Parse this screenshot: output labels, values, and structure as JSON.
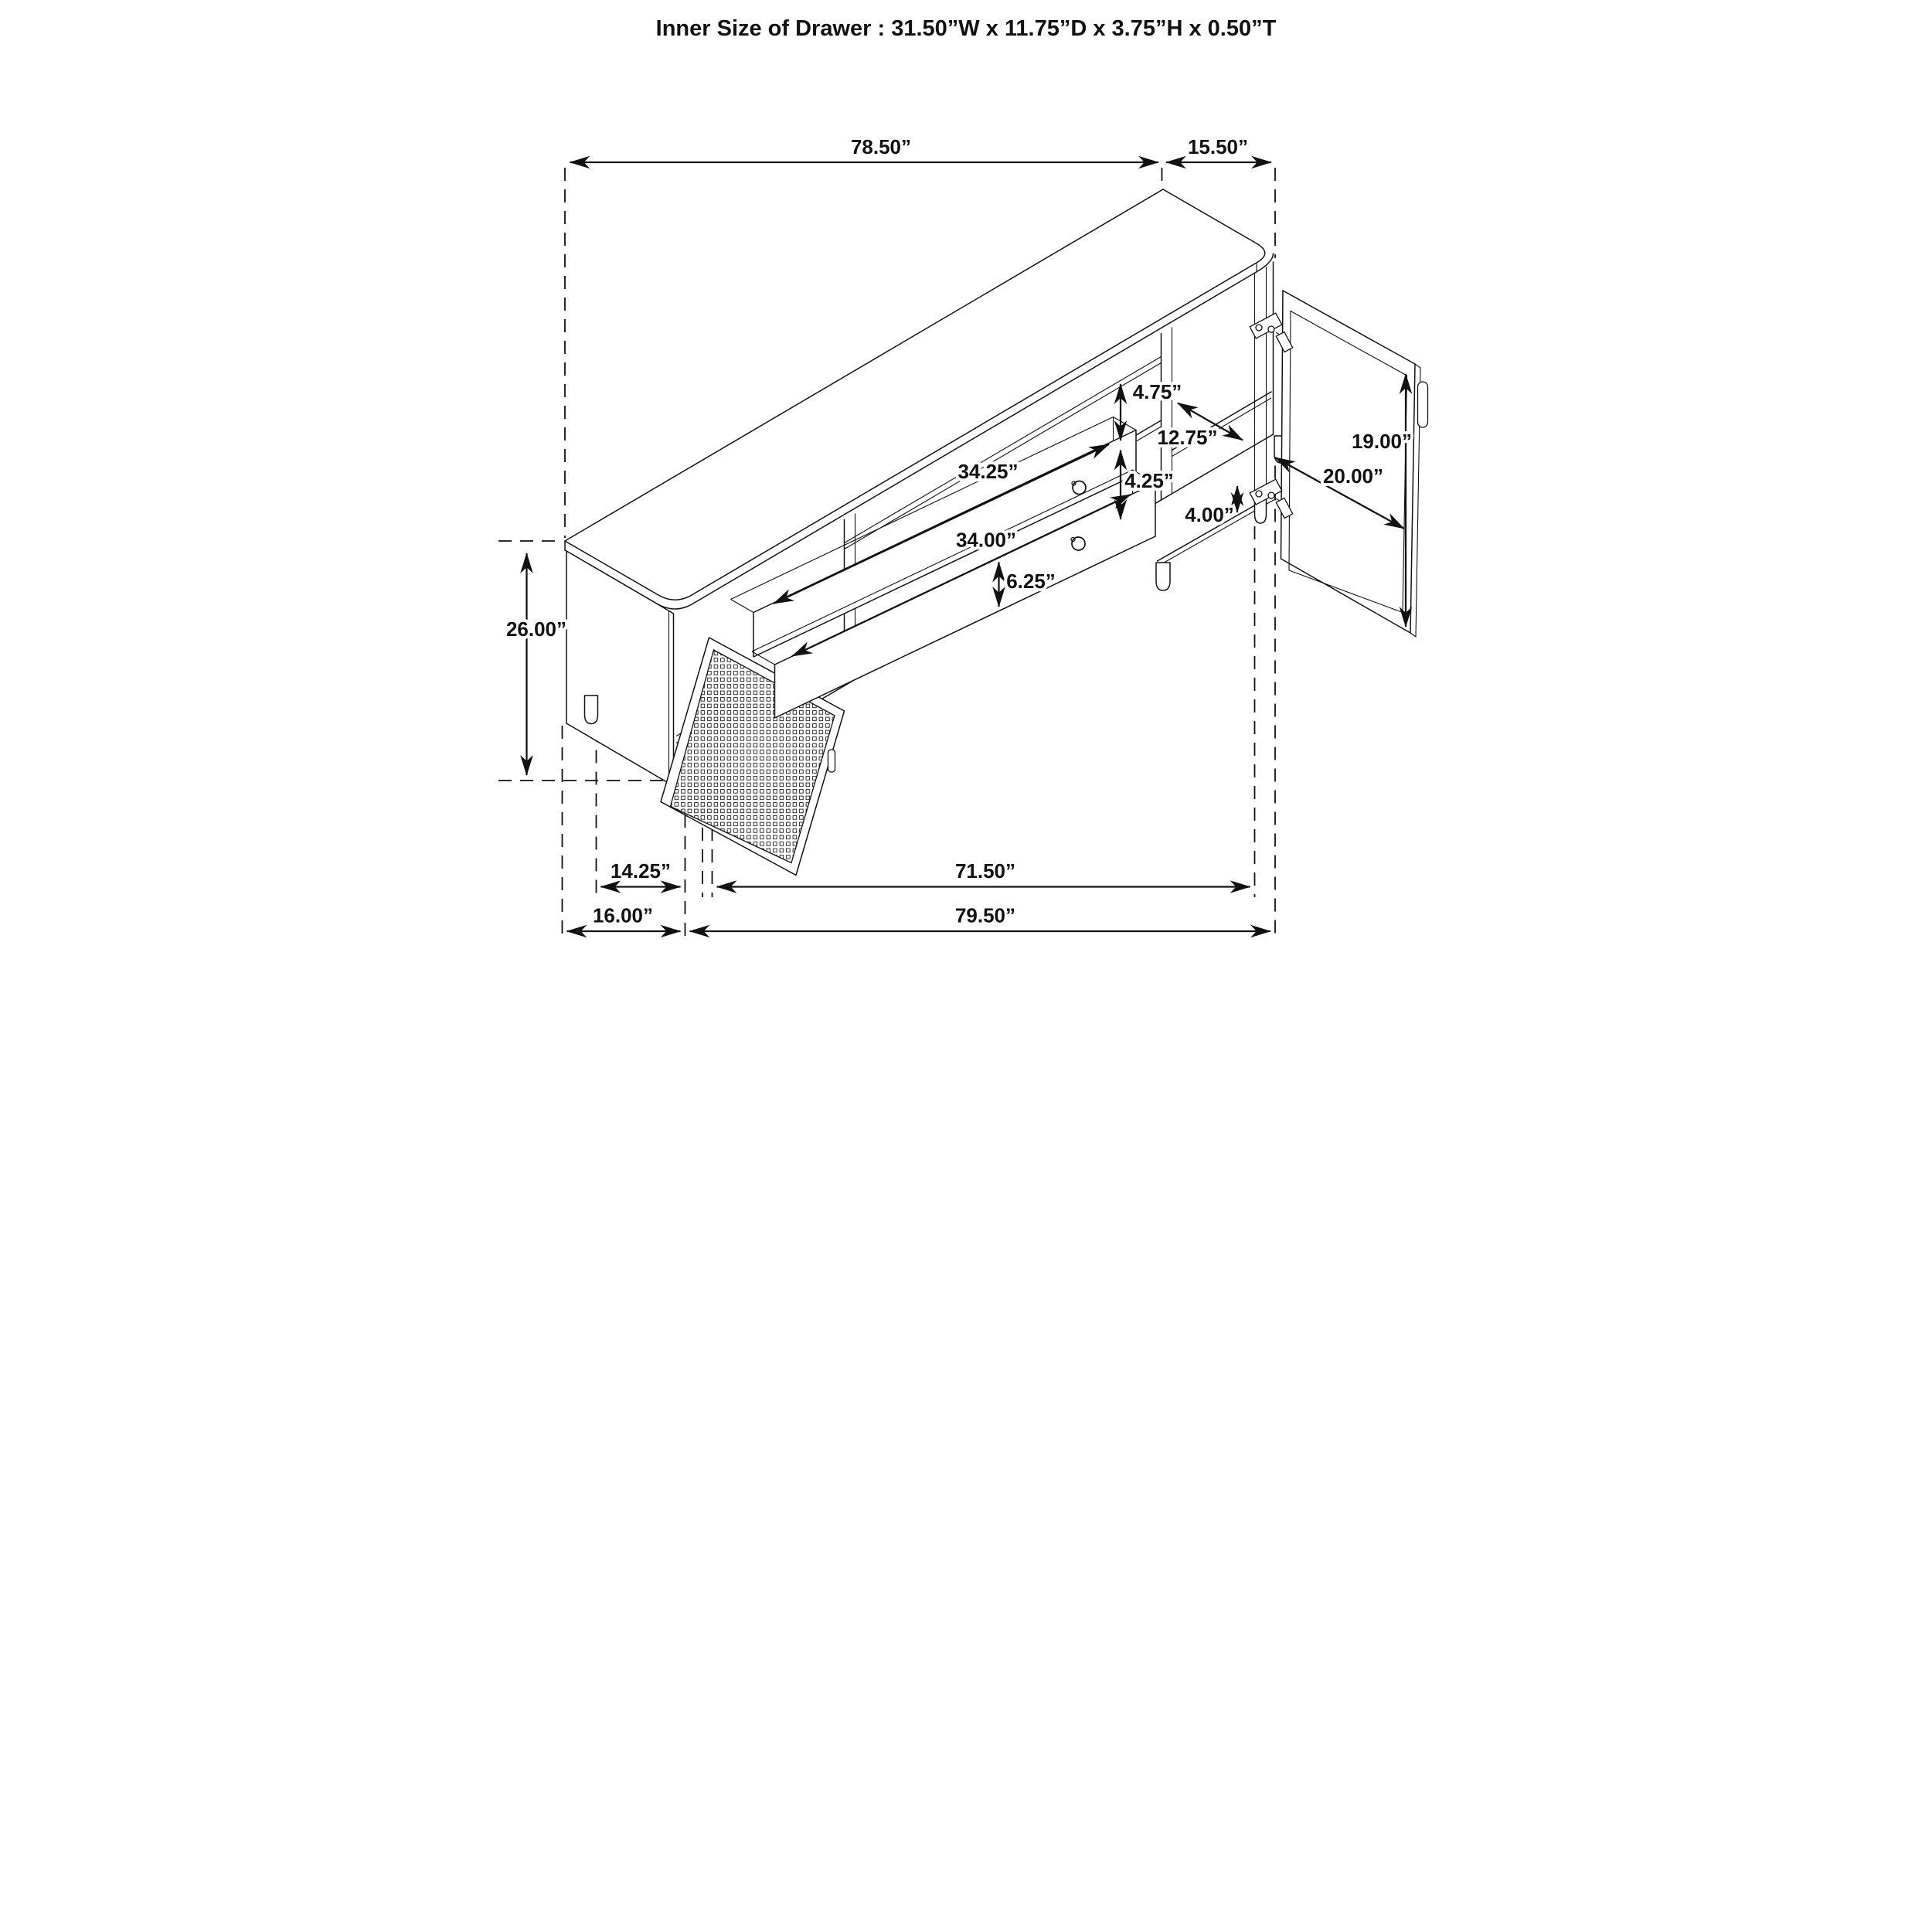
{
  "title": "Inner Size of Drawer : 31.50”W x 11.75”D x 3.75”H x 0.50”T",
  "diagram_type": "furniture-dimension-drawing",
  "subject": "TV console sideboard with cane mesh door, two drawers and glass door, isometric view",
  "dims": {
    "top_width": "78.50”",
    "top_depth": "15.50”",
    "overall_height": "26.00”",
    "shelf_opening_height": "4.75”",
    "door_opening_depth": "12.75”",
    "drawer_opening_height": "4.25”",
    "glass_door_height": "19.00”",
    "glass_door_width": "20.00”",
    "leg_clearance": "4.00”",
    "drawer_width_top": "34.25”",
    "drawer_width_bottom": "34.00”",
    "drawer_front_height": "6.25”",
    "leg_inset": "14.25”",
    "base_span": "71.50”",
    "side_depth": "16.00”",
    "overall_base_width": "79.50”"
  }
}
